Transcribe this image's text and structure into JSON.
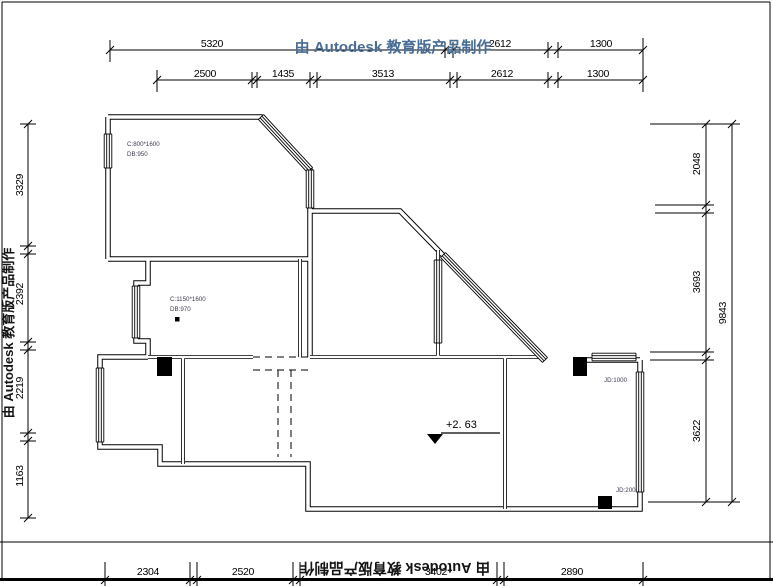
{
  "watermark": {
    "text": "由 Autodesk 教育版产品制作"
  },
  "colors": {
    "watermark_top": "#4a6d96",
    "watermark_side": "#141414",
    "ink": "#000000",
    "small_label": "#3c3c50"
  },
  "dimensions": {
    "top_outer": [
      "5320",
      "2612",
      "1300"
    ],
    "top_inner": [
      "2500",
      "1435",
      "3513",
      "2612",
      "1300"
    ],
    "left": [
      "3329",
      "2392",
      "2219",
      "1163"
    ],
    "right_inner": [
      "2048",
      "3693",
      "3622"
    ],
    "right_total": "9843",
    "bottom": [
      "2304",
      "2520",
      "3402",
      "2890"
    ]
  },
  "plan_labels": {
    "window_a_spec": "C:800*1600",
    "window_a_sill": "DB:950",
    "window_b_spec": "C:1150*1600",
    "window_b_sill": "DB:970",
    "jd_upper": "JD:1000",
    "jd_lower": "JD:200",
    "elevation": "+2. 63"
  }
}
